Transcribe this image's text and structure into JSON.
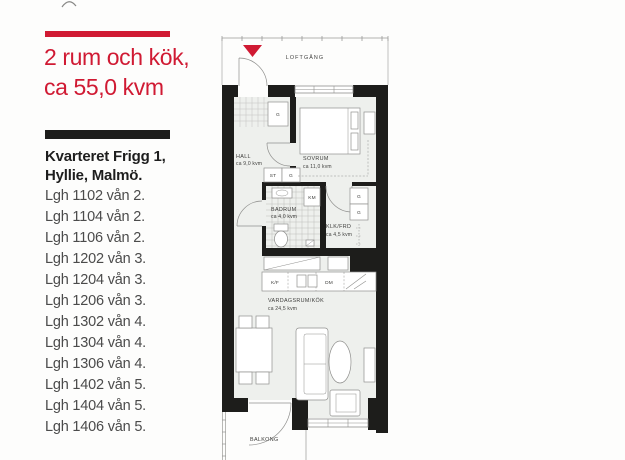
{
  "left_panel": {
    "accent_color": "#d01a33",
    "title_line1": "2 rum och kök,",
    "title_line2": "ca 55,0  kvm",
    "address_line1": "Kvarteret Frigg 1,",
    "address_line2": "Hyllie, Malmö.",
    "apartments": [
      "Lgh 1102 vån 2.",
      "Lgh 1104 vån 2.",
      "Lgh 1106 vån 2.",
      "Lgh 1202 vån 3.",
      "Lgh 1204 vån 3.",
      "Lgh 1206 vån 3.",
      "Lgh 1302 vån 4.",
      "Lgh 1304 vån 4.",
      "Lgh 1306 vån 4.",
      "Lgh 1402 vån 5.",
      "Lgh 1404 vån 5.",
      "Lgh 1406 vån 5."
    ]
  },
  "floorplan": {
    "labels": {
      "loftgang": "LOFTGÅNG",
      "hall": "HALL",
      "hall_area": "ca 9,0 kvm",
      "sovrum": "SOVRUM",
      "sovrum_area": "ca 11,0 kvm",
      "badrum": "BADRUM",
      "badrum_area": "ca 4,0 kvm",
      "klk": "KLK/FRD",
      "klk_area": "ca 4,5 kvm",
      "vardagsrum": "VARDAGSRUM/KÖK",
      "vardagsrum_area": "ca 24,5 kvm",
      "balkong": "BALKONG",
      "km": "KM",
      "st": "ST",
      "g": "G",
      "kf": "K/F",
      "dm": "DM"
    },
    "colors": {
      "wall": "#1d1d1b",
      "room_fill": "#eef0ed",
      "entry_marker": "#d01a33"
    }
  }
}
